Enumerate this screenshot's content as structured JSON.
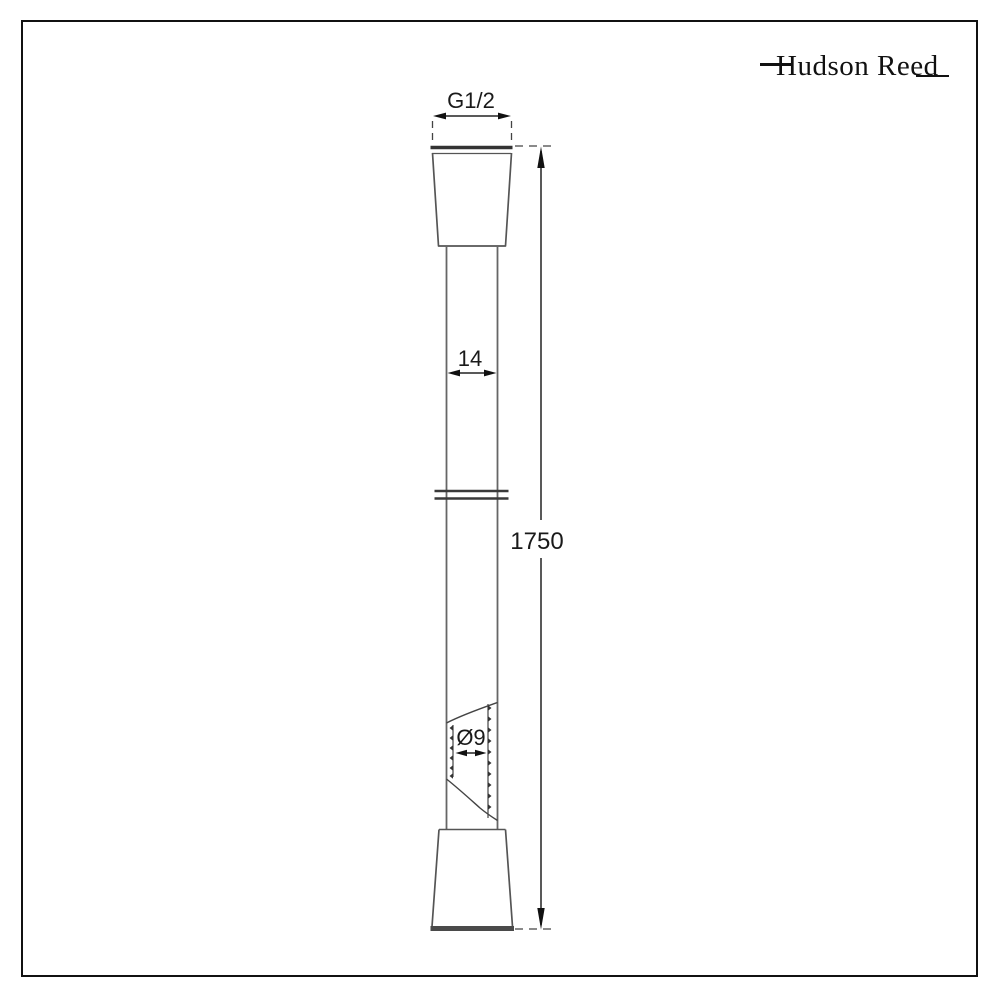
{
  "brand": {
    "logo_text": "Hudson Reed"
  },
  "drawing": {
    "dimensions": {
      "thread_label": "G1/2",
      "width_label": "14",
      "length_label": "1750",
      "inner_diameter_label": "Ø9"
    },
    "colors": {
      "background": "#ffffff",
      "frame": "#111111",
      "outline_line": "#666666",
      "dimension_line": "#222222",
      "text": "#1a1a1a"
    }
  }
}
